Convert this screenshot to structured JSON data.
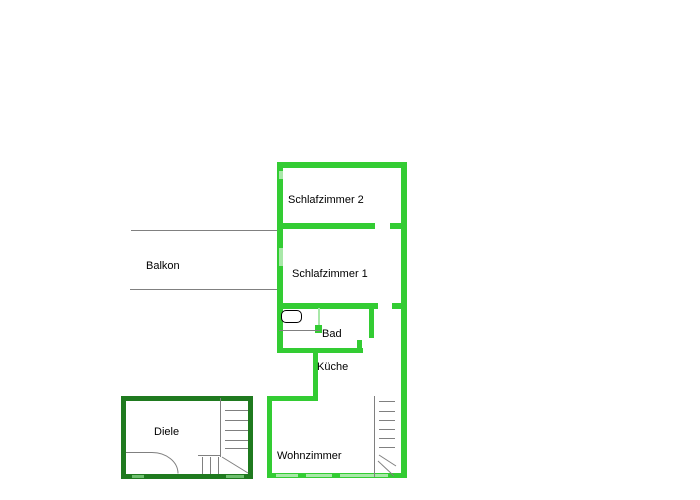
{
  "colors": {
    "wall_main": "#33cc33",
    "wall_pale": "#a8e8a8",
    "wall_dark": "#1f7a1f",
    "wall_dark_pale": "#6fbf6f",
    "line": "#808080",
    "text": "#000000",
    "background": "#ffffff"
  },
  "rooms": {
    "schlafzimmer2": {
      "label": "Schlafzimmer 2"
    },
    "schlafzimmer1": {
      "label": "Schlafzimmer 1"
    },
    "balkon": {
      "label": "Balkon"
    },
    "bad": {
      "label": "Bad"
    },
    "kueche": {
      "label": "Küche"
    },
    "diele": {
      "label": "Diele"
    },
    "wohnzimmer": {
      "label": "Wohnzimmer"
    }
  }
}
